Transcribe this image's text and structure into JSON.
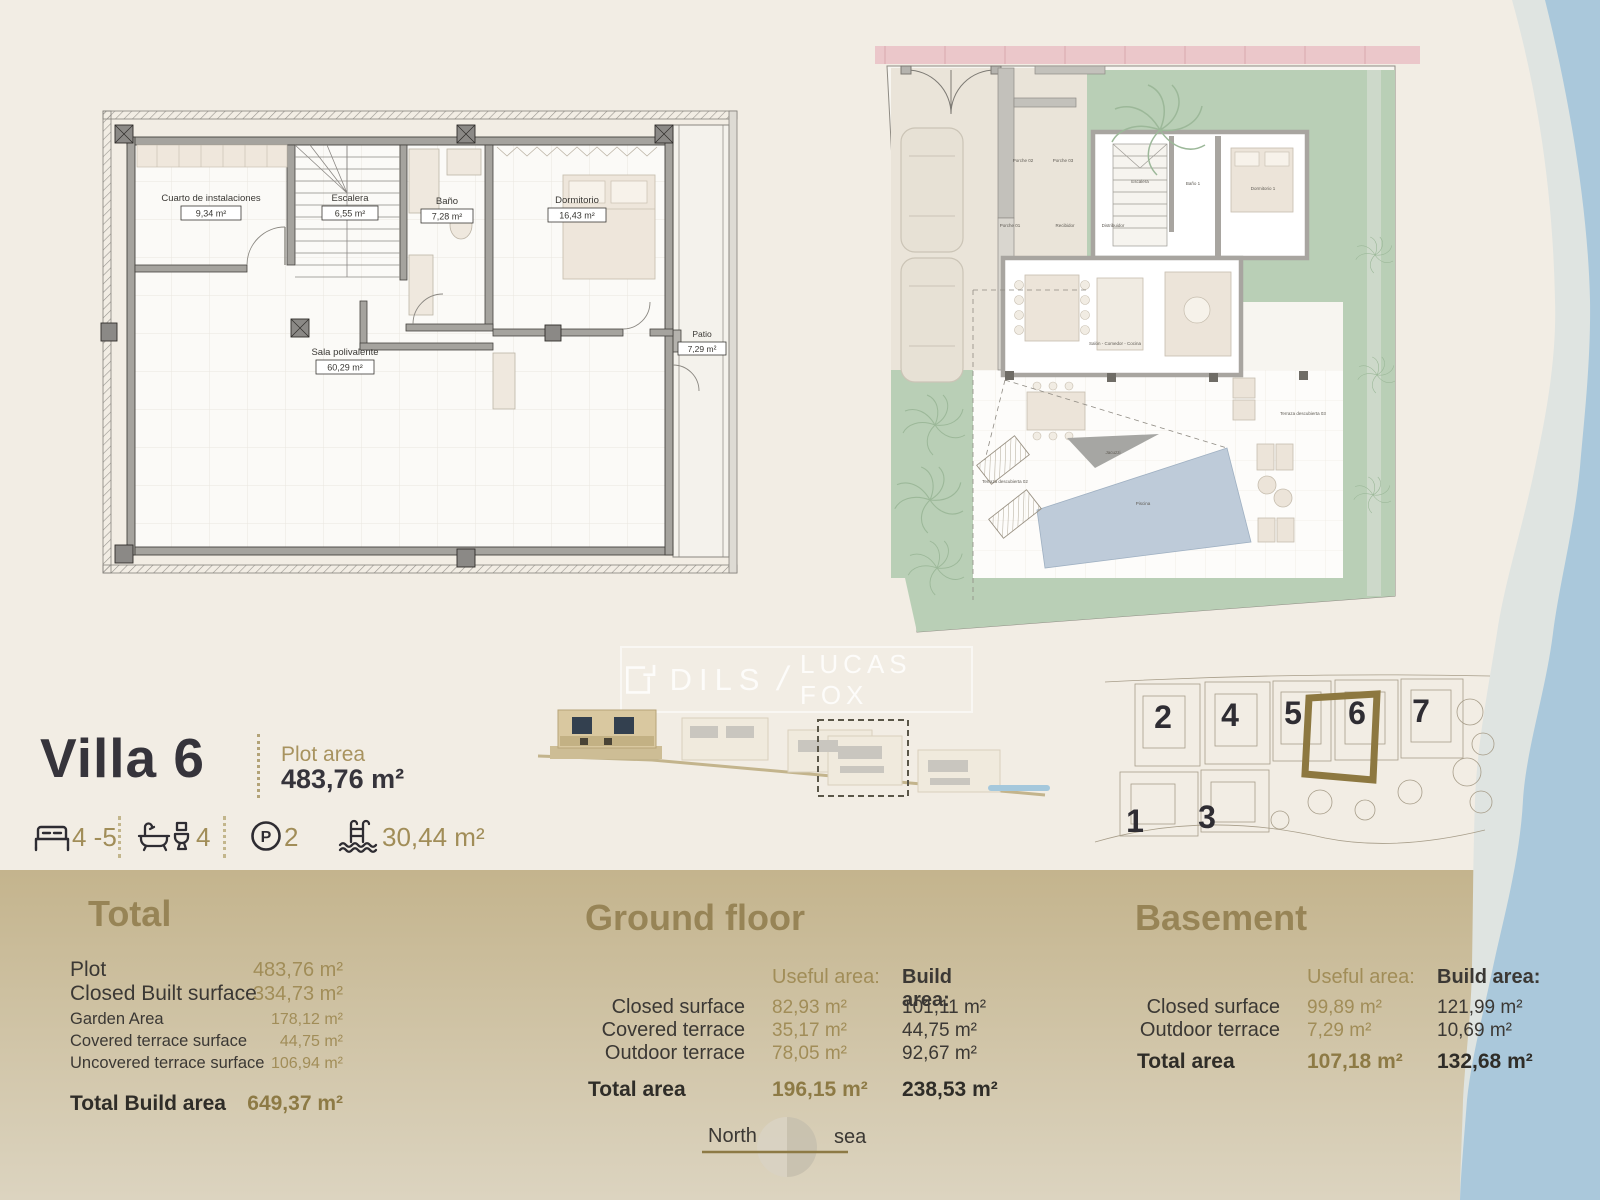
{
  "colors": {
    "cream": "#f2ede4",
    "band_top": "#c4b48d",
    "band_bottom": "#dcd4c0",
    "gold": "#a18d58",
    "gold_head": "#978456",
    "dark": "#36343b",
    "sea_light": "#dfe4e1",
    "sea_blue": "#aac8db",
    "garden": "#b9cfb6",
    "pool": "#becbd9",
    "pink": "#ebc7ca",
    "hl": "#8d7840"
  },
  "watermark": {
    "brand1": "DILS",
    "separator": "/",
    "brand2": "LUCAS FOX"
  },
  "villa": {
    "title": "Villa 6",
    "plot_area_label": "Plot area",
    "plot_area_value": "483,76 m²",
    "features": {
      "beds": "4 -5",
      "baths": "4",
      "parking": "2",
      "pool": "30,44 m²"
    }
  },
  "basement_plan": {
    "rooms": [
      {
        "name": "Cuarto de instalaciones",
        "area": "9,34 m²"
      },
      {
        "name": "Escalera",
        "area": "6,55 m²"
      },
      {
        "name": "Baño",
        "area": "7,28 m²"
      },
      {
        "name": "Dormitorio",
        "area": "16,43 m²"
      },
      {
        "name": "Sala polivalente",
        "area": "60,29 m²"
      },
      {
        "name": "Patio",
        "area": "7,29 m²"
      }
    ]
  },
  "ground_plan": {
    "labels": [
      "Porche 02",
      "Porche 03",
      "Porche 01",
      "Recibidor",
      "Distribuidor",
      "Escalera",
      "Baño 1",
      "Dormitorio 1",
      "Salón - Comedor - Cocina",
      "Jacuzzi",
      "Piscina",
      "Terraza descubierta 02",
      "Terraza descubierta 03"
    ]
  },
  "site_plan": {
    "villas": [
      "2",
      "4",
      "5",
      "6",
      "7",
      "1",
      "3"
    ],
    "highlighted": "6"
  },
  "totals": {
    "heading": "Total",
    "rows": [
      {
        "label": "Plot",
        "value": "483,76 m²"
      },
      {
        "label": "Closed Built surface",
        "value": "334,73 m²"
      },
      {
        "label": "Garden Area",
        "value": "178,12 m²"
      },
      {
        "label": "Covered terrace surface",
        "value": "44,75 m²"
      },
      {
        "label": "Uncovered terrace surface",
        "value": "106,94 m²"
      }
    ],
    "total_label": "Total Build area",
    "total_value": "649,37 m²"
  },
  "ground_floor": {
    "heading": "Ground floor",
    "col_useful": "Useful area:",
    "col_build": "Build area:",
    "rows": [
      {
        "label": "Closed surface",
        "useful": "82,93 m²",
        "build": "101,11 m²"
      },
      {
        "label": "Covered terrace",
        "useful": "35,17 m²",
        "build": "44,75 m²"
      },
      {
        "label": "Outdoor terrace",
        "useful": "78,05 m²",
        "build": "92,67 m²"
      }
    ],
    "total_label": "Total area",
    "total_useful": "196,15 m²",
    "total_build": "238,53 m²"
  },
  "basement": {
    "heading": "Basement",
    "col_useful": "Useful area:",
    "col_build": "Build area:",
    "rows": [
      {
        "label": "Closed surface",
        "useful": "99,89 m²",
        "build": "121,99 m²"
      },
      {
        "label": "Outdoor terrace",
        "useful": "7,29 m²",
        "build": "10,69 m²"
      }
    ],
    "total_label": "Total area",
    "total_useful": "107,18 m²",
    "total_build": "132,68 m²"
  },
  "compass": {
    "north": "North",
    "sea": "sea"
  }
}
